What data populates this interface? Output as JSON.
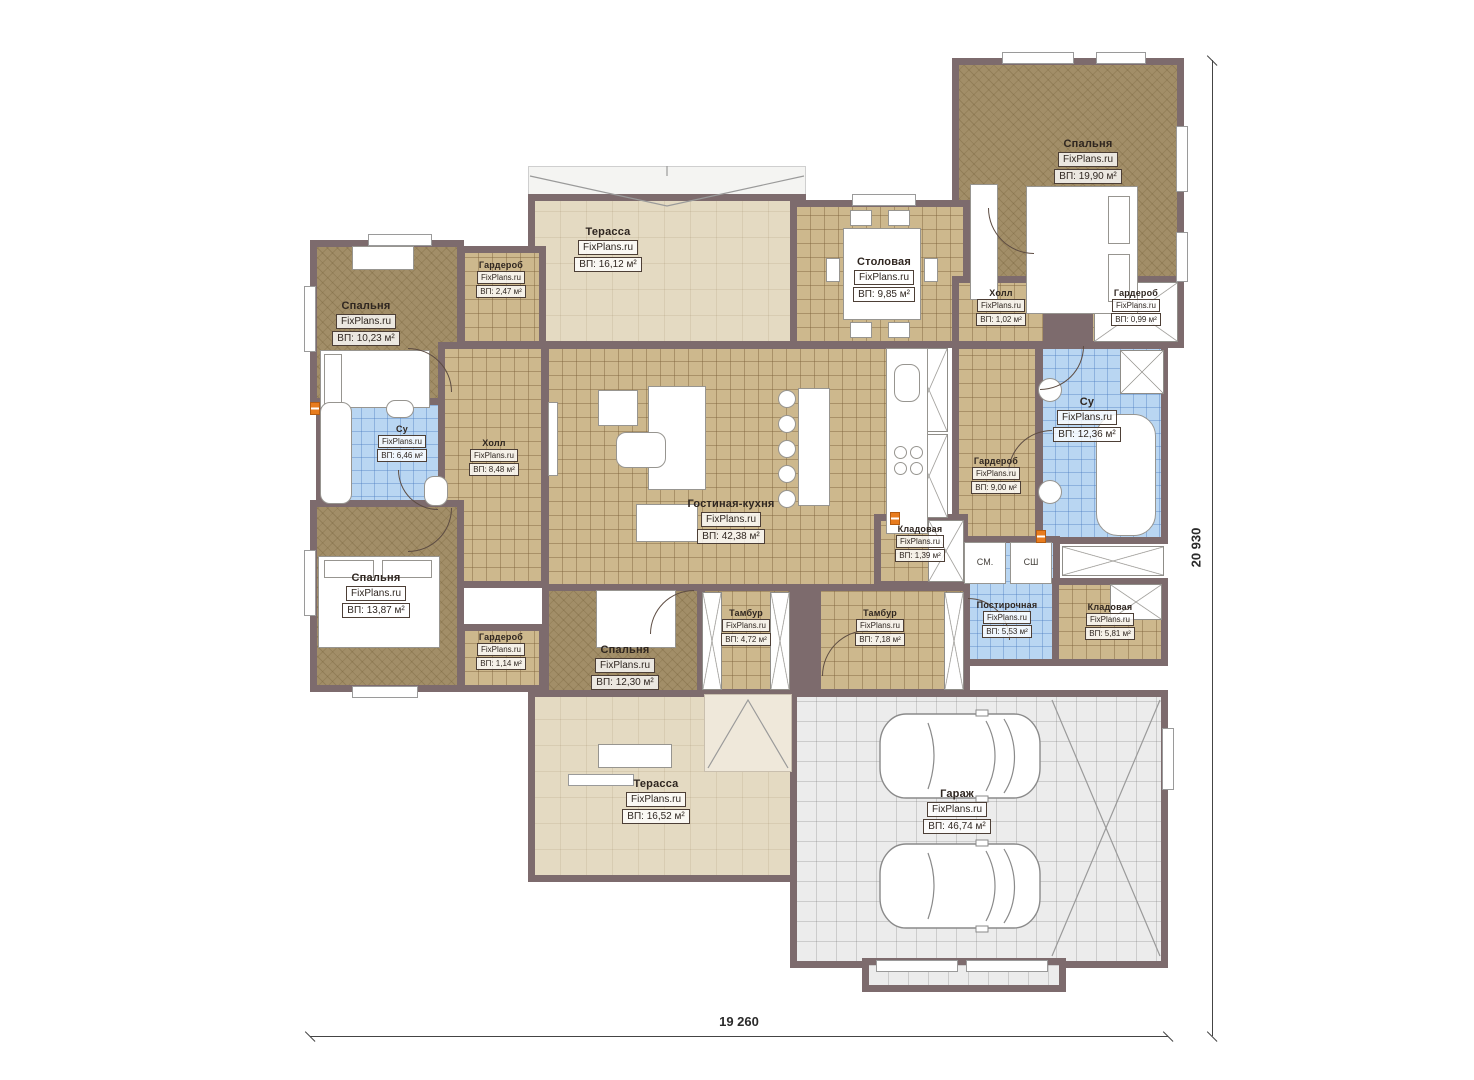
{
  "plan": {
    "watermark": "FixPlans.ru",
    "dimensions": {
      "width_label": "19 260",
      "height_label": "20 930"
    },
    "appliances": {
      "washer": "СМ.",
      "dryer": "СШ"
    },
    "colors": {
      "wall": "#7d6b6d",
      "floor_wood": "#a28e68",
      "floor_tile": "#cdb88d",
      "floor_bath": "#b9d6f2",
      "floor_terrace": "#e4dac2",
      "floor_garage": "#ececec",
      "socket": "#e87c1e"
    },
    "rooms": [
      {
        "id": "bedroom-top-right",
        "name": "Спальня",
        "area": "ВП: 19,90 м²"
      },
      {
        "id": "terrace-top",
        "name": "Терасса",
        "area": "ВП: 16,12 м²"
      },
      {
        "id": "dining",
        "name": "Столовая",
        "area": "ВП: 9,85 м²"
      },
      {
        "id": "hall-small",
        "name": "Холл",
        "area": "ВП: 1,02 м²"
      },
      {
        "id": "wardrobe-top-right",
        "name": "Гардероб",
        "area": "ВП: 0,99 м²"
      },
      {
        "id": "wardrobe-top-left",
        "name": "Гардероб",
        "area": "ВП: 2,47 м²"
      },
      {
        "id": "bedroom-top-left",
        "name": "Спальня",
        "area": "ВП: 10,23 м²"
      },
      {
        "id": "bath-left",
        "name": "Су",
        "area": "ВП: 6,46 м²"
      },
      {
        "id": "hall-left",
        "name": "Холл",
        "area": "ВП: 8,48 м²"
      },
      {
        "id": "living-kitchen",
        "name": "Гостиная-кухня",
        "area": "ВП: 42,38 м²"
      },
      {
        "id": "wardrobe-right",
        "name": "Гардероб",
        "area": "ВП: 9,00 м²"
      },
      {
        "id": "bath-right",
        "name": "Су",
        "area": "ВП: 12,36 м²"
      },
      {
        "id": "bedroom-left",
        "name": "Спальня",
        "area": "ВП: 13,87 м²"
      },
      {
        "id": "wardrobe-bottom-left",
        "name": "Гардероб",
        "area": "ВП: 1,14 м²"
      },
      {
        "id": "bedroom-bottom",
        "name": "Спальня",
        "area": "ВП: 12,30 м²"
      },
      {
        "id": "tambour-left",
        "name": "Тамбур",
        "area": "ВП: 4,72 м²"
      },
      {
        "id": "tambour-right",
        "name": "Тамбур",
        "area": "ВП: 7,18 м²"
      },
      {
        "id": "pantry-small",
        "name": "Кладовая",
        "area": "ВП: 1,39 м²"
      },
      {
        "id": "laundry",
        "name": "Постирочная",
        "area": "ВП: 5,53 м²"
      },
      {
        "id": "pantry-right",
        "name": "Кладовая",
        "area": "ВП: 5,81 м²"
      },
      {
        "id": "terrace-bottom",
        "name": "Терасса",
        "area": "ВП: 16,52 м²"
      },
      {
        "id": "garage",
        "name": "Гараж",
        "area": "ВП: 46,74 м²"
      }
    ]
  }
}
